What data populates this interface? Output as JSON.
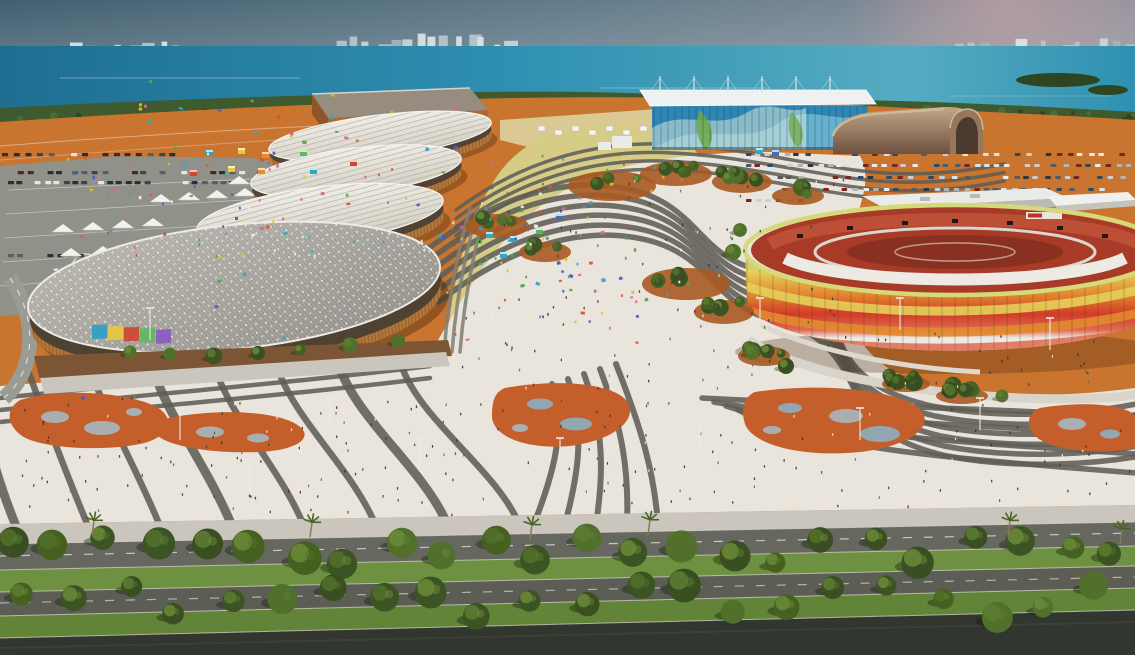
{
  "scene": {
    "kind": "aerial-architectural-rendering",
    "subject": "olympic-park-master-plan",
    "elements": [
      "lagoon-water",
      "city-skyline",
      "sun-glow",
      "oval-arena-1",
      "oval-arena-2",
      "oval-arena-3",
      "velodrome-arena",
      "training-hall",
      "aquatics-center",
      "arched-pavilion",
      "round-stadium",
      "service-building",
      "tent-building",
      "olympic-way-plaza",
      "left-parking-lot",
      "right-parking-lot",
      "tree-boulevard",
      "crowd"
    ]
  },
  "palette": {
    "sky_left": "#415f70",
    "sky_mid": "#627c8a",
    "sky_right": "#8e929d",
    "sun_glow": "#cfa3a6",
    "water_deep": "#1e6e91",
    "water_mid": "#2f90b1",
    "water_light": "#55acc2",
    "skyline_light": "#ccd5da",
    "skyline_dark": "#a4b4bd",
    "shore_green": "#3e5a2e",
    "shore_green_dark": "#2e4522",
    "terracotta": "#c9742f",
    "terracotta_light": "#da9352",
    "terracotta_dark": "#a85a22",
    "plaza": "#e9e5dc",
    "stripe": "#5e5d56",
    "stripe_light": "#828076",
    "amoeba": "#c45f2b",
    "spot_gray": "#abaeb0",
    "spot_blue": "#93a7b2",
    "sand": "#d7cc86",
    "beach_sand": "#ddd3a0",
    "arena_roof": "#f0eee8",
    "arena_roof_shade": "#d3cec3",
    "arena_rib": "#9b9384",
    "arena_wall": "#b5763c",
    "arena_glass": "#473e33",
    "velo_light": "#b9b6af",
    "velo_dark": "#8e8b85",
    "hall_roof": "#968c80",
    "hall_wall": "#ad6a33",
    "hall_side": "#8e5526",
    "aqua_roof": "#eef1f1",
    "aqua_blue": "#2f86b4",
    "aqua_wave": "#7fc3d8",
    "aqua_pale": "#d5e8da",
    "aqua_green": "#6fa844",
    "hangar_light": "#c2a787",
    "hangar_dark": "#6e5140",
    "hangar_face": "#97775c",
    "st_lime": "#cdd06e",
    "st_yellow": "#e4cf5a",
    "st_orange": "#e2892f",
    "st_red": "#d23c28",
    "st_red_light": "#e06a50",
    "st_base": "#eceae2",
    "st_rim": "#d6d97a",
    "seats_red": "#a83a28",
    "seats_light": "#c05238",
    "field_red": "#8a3020",
    "white_bldg": "#e9ebe8",
    "bldg_shadow": "#b9bbb4",
    "parking": "#90928a",
    "park_line": "#d9d9d3",
    "road": "#66685f",
    "road2": "#5c5e56",
    "road_dark": "#31362e",
    "curb": "#d7d4ca",
    "grass": "#6d9140",
    "grass2": "#618438",
    "tree_dark": "#3c5423",
    "tree_mid": "#4a6428",
    "tree_light": "#5f7e33",
    "dirt": "#7c5634",
    "walkway": "#cac6bd",
    "pole": "#eaeae5"
  },
  "color_lists": {
    "car_colors": [
      "#e9ebeb",
      "#dfe2e4",
      "#c9ced2",
      "#30343c",
      "#7a2620",
      "#2a4a66",
      "#555a60",
      "#b0b4b8"
    ],
    "dark_car_colors": [
      "#2c2f36",
      "#4c2620",
      "#24303c",
      "#5a5e64",
      "#e3e5e6",
      "#3c444e"
    ],
    "people_colors": [
      "#32323a",
      "#5a2a24",
      "#26404f",
      "#7a6a50",
      "#3c5a30",
      "#e8e6df",
      "#403048"
    ],
    "bright_colors": [
      "#2ea8c4",
      "#e3bc2e",
      "#d8542e",
      "#50a84e",
      "#d06a9a",
      "#4a5ac0",
      "#f0eee8"
    ],
    "kiosk_colors": [
      "#2ea8c4",
      "#e8c93e",
      "#d0452e",
      "#5cb85c",
      "#3b6fc0",
      "#e88a2e"
    ],
    "mural_colors": [
      "#2e9ec4",
      "#e8c93e",
      "#d0452e",
      "#5cb85c",
      "#8a5ac0"
    ],
    "skyline_colors": [
      "#ccd5da",
      "#a4b4bd",
      "#dde4e8",
      "#b9c6cd"
    ],
    "tree_greens": [
      "#3c5423",
      "#46611f",
      "#50702c",
      "#3a4f21"
    ],
    "tree_highlights": [
      "#5d7c31",
      "#6b8a38",
      "#52702a"
    ]
  },
  "generated": {
    "skyline": {
      "left": 8,
      "mid": 14,
      "low": 22,
      "right_low": 14,
      "far": 16
    },
    "shore_trees": 70,
    "cars_right": 120,
    "cars_left": 66,
    "tents": 13,
    "beach_tents": 8,
    "people": {
      "left": 120,
      "center": 110,
      "right": 90,
      "stadium_walk": 30,
      "sand": 60,
      "arena_front": 55
    },
    "confetti": {
      "arena": 55,
      "sand": 45
    },
    "kiosks": 16,
    "mounds": 11,
    "bottom_trees": 46,
    "palms": 6,
    "poles": 14,
    "mural_panels": 5,
    "stripes": {
      "upper_s": 6,
      "beach": 4,
      "left_fan": 8,
      "center_fan": 5,
      "right_fan": 4,
      "upper_left": 3,
      "sand_edge": 3
    },
    "amoeba_patches": 5
  }
}
